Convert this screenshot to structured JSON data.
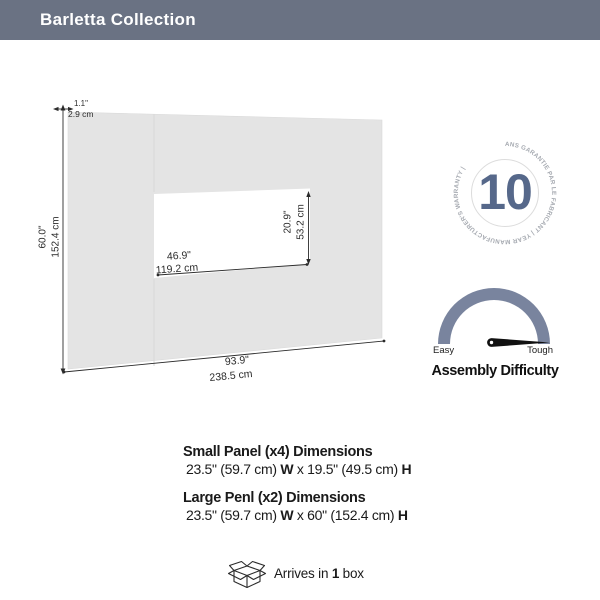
{
  "header": {
    "title": "Barletta Collection"
  },
  "diagram": {
    "thickness_in": "1.1\"",
    "thickness_cm": "2.9 cm",
    "height_in": "60.0\"",
    "height_cm": "152.4 cm",
    "width_in": "93.9\"",
    "width_cm": "238.5 cm",
    "cutout_width_in": "46.9\"",
    "cutout_width_cm": "119.2 cm",
    "cutout_height_in": "20.9\"",
    "cutout_height_cm": "53.2 cm"
  },
  "warranty_badge": {
    "years": "10",
    "ring_text": "ANS GARANTIE PAR LE FABRICANT  |  YEAR MANUFACTURER'S WARRANTY  |"
  },
  "assembly_gauge": {
    "left_label": "Easy",
    "right_label": "Tough",
    "title": "Assembly Difficulty",
    "needle_position": "tough"
  },
  "specs": {
    "small_panel": {
      "title": "Small Panel (x4) Dimensions",
      "dims_pre": "23.5\" (59.7 cm) ",
      "w_label": "W",
      "dims_mid": " x 19.5\" (49.5 cm) ",
      "h_label": "H"
    },
    "large_panel": {
      "title": "Large Penl (x2) Dimensions",
      "dims_pre": "23.5\" (59.7 cm) ",
      "w_label": "W",
      "dims_mid": " x 60\" (152.4 cm) ",
      "h_label": "H"
    }
  },
  "shipping": {
    "text_pre": "Arrives in ",
    "box_count": "1",
    "text_post": " box"
  },
  "colors": {
    "header_bg": "#6A7283",
    "panel_fill": "#E4E4E4",
    "warranty_accent": "#56688A",
    "ring_text_gray": "#A6AAB1",
    "gauge_arc": "#79849E"
  }
}
